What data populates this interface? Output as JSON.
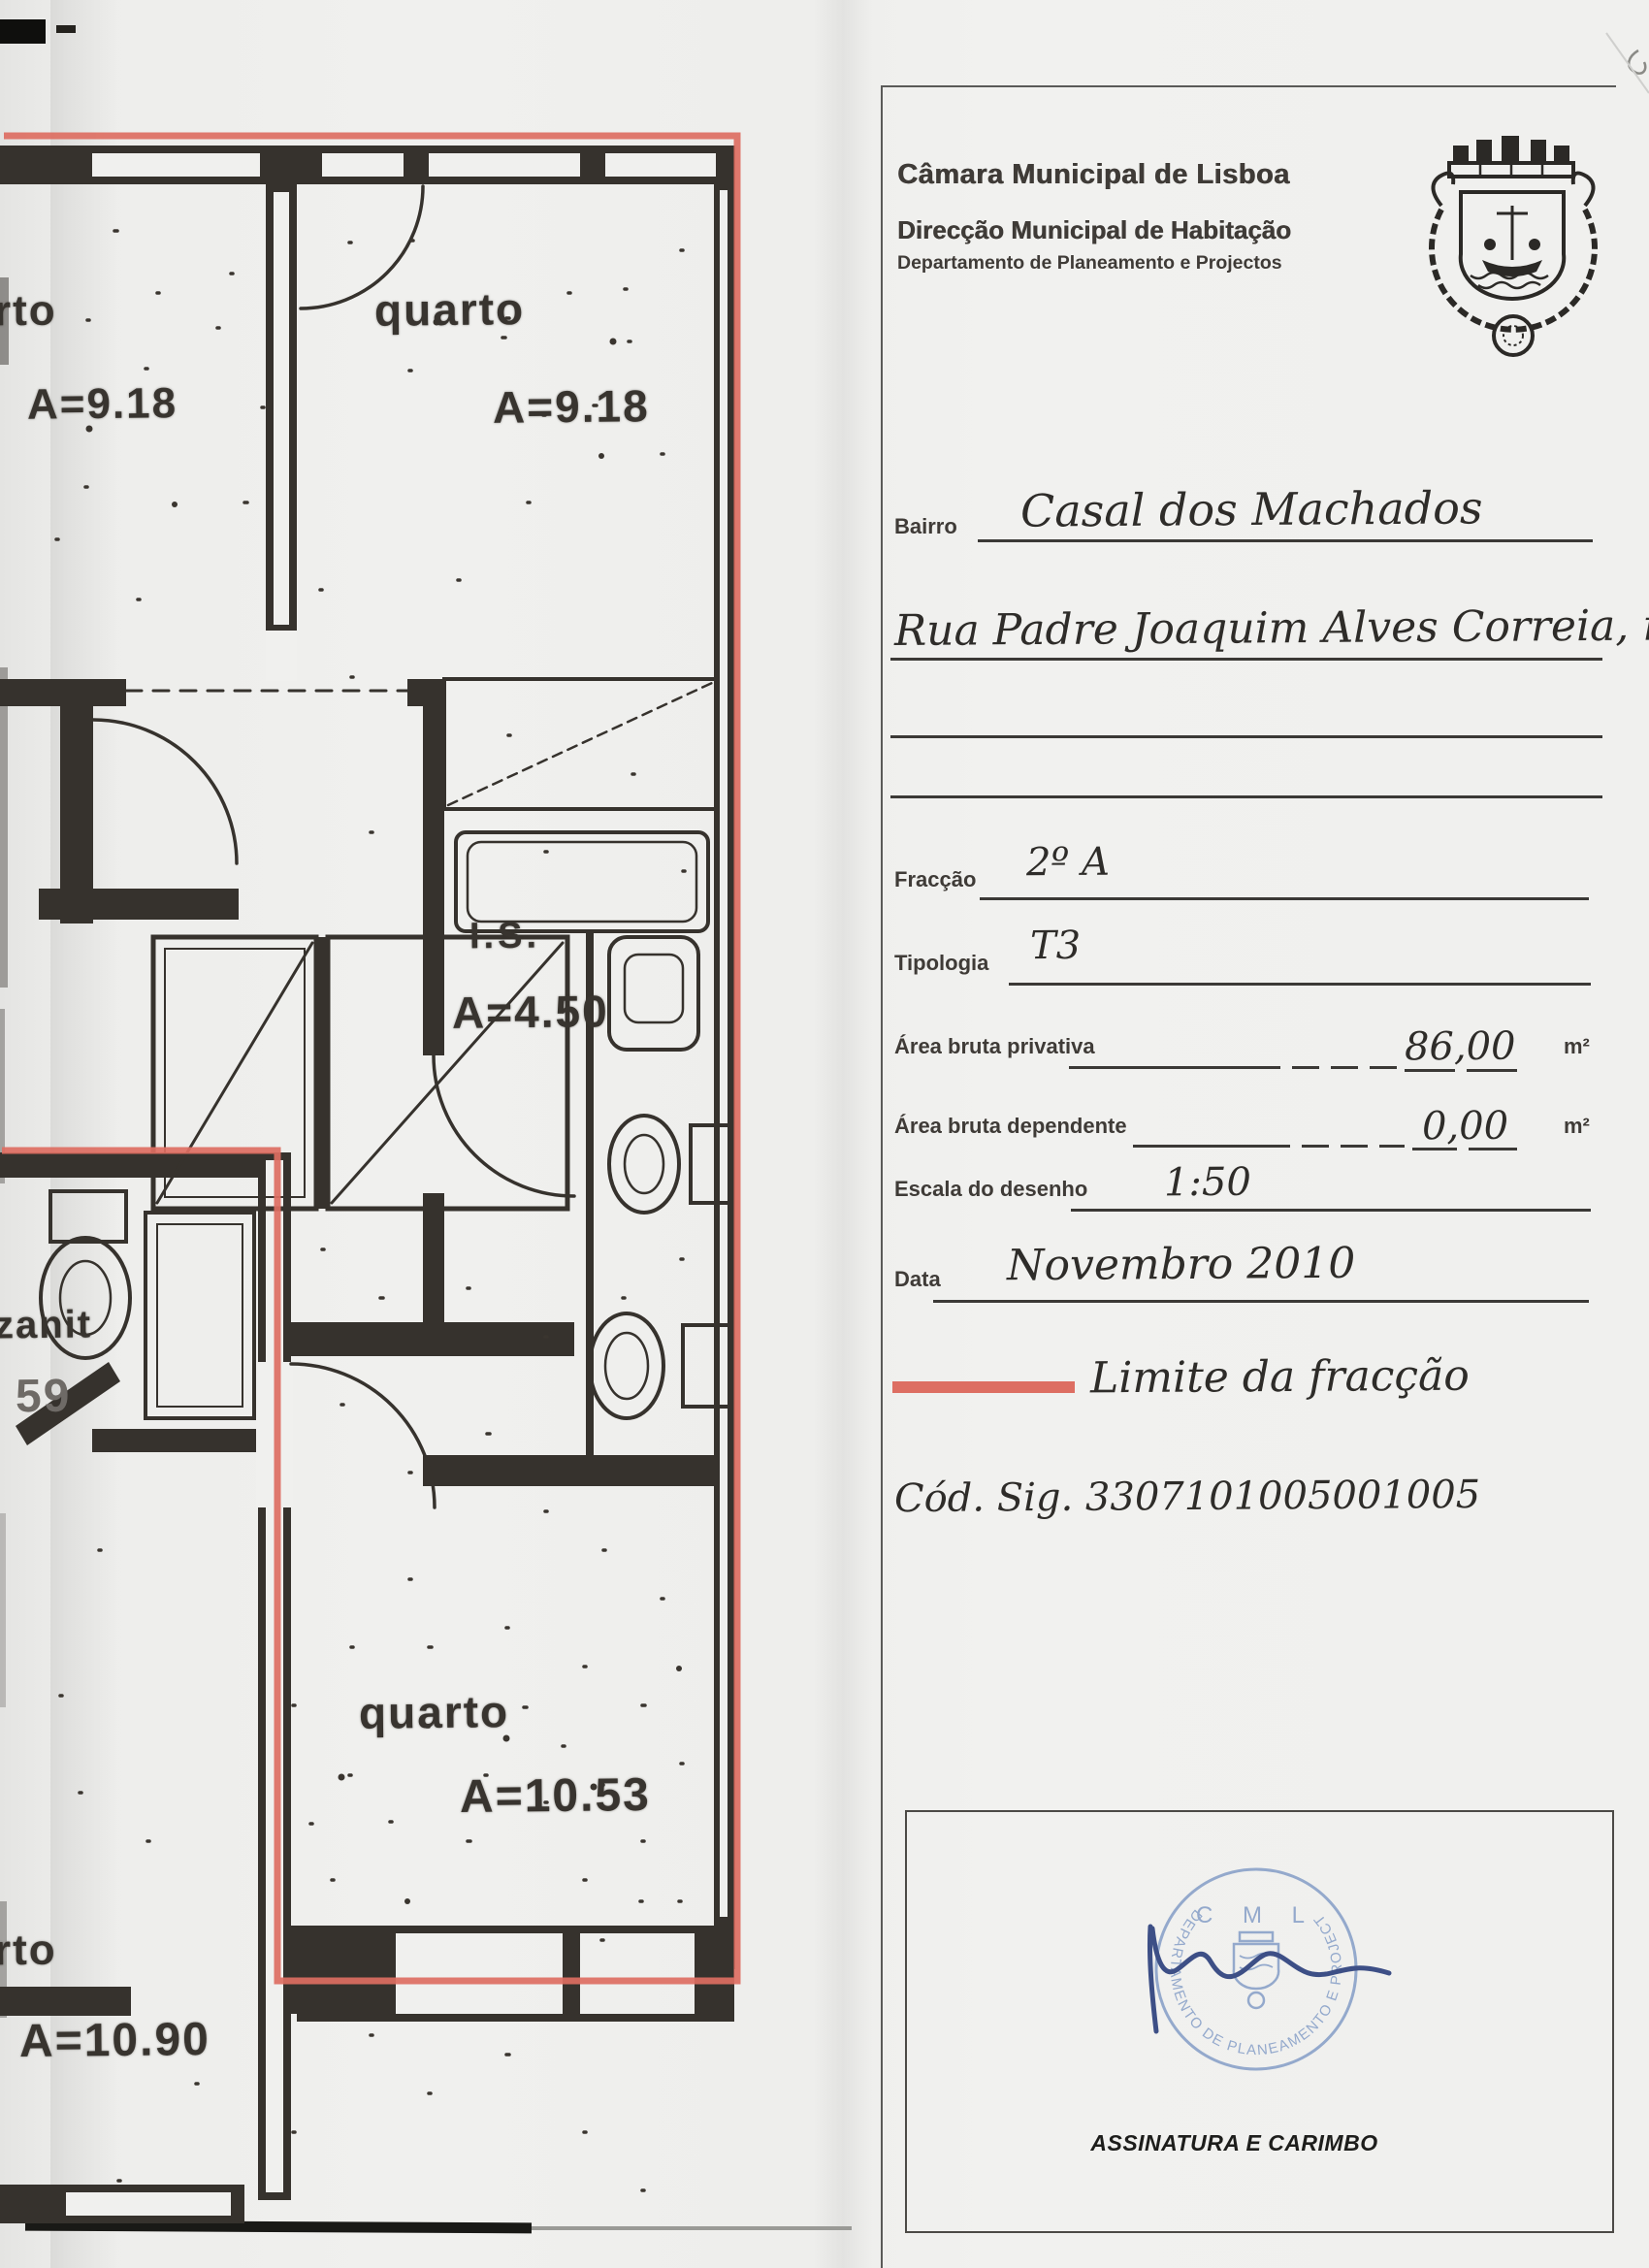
{
  "header": {
    "org": "Câmara Municipal de Lisboa",
    "dept": "Direcção Municipal de Habitação",
    "subdept": "Departamento de Planeamento e Projectos"
  },
  "form": {
    "bairro_label": "Bairro",
    "bairro_value": "Casal dos Machados",
    "address_value": "Rua Padre Joaquim Alves Correia, nº 6",
    "fraccao_label": "Fracção",
    "fraccao_value": "2º A",
    "tipologia_label": "Tipologia",
    "tipologia_value": "T3",
    "area_privativa_label": "Área bruta privativa",
    "area_privativa_value": "86,00",
    "area_privativa_unit": "m²",
    "area_dependente_label": "Área bruta dependente",
    "area_dependente_value": "0,00",
    "area_dependente_unit": "m²",
    "escala_label": "Escala do desenho",
    "escala_value": "1:50",
    "data_label": "Data",
    "data_value": "Novembro 2010",
    "legend_label": "Limite da fracção",
    "cod_sig": "Cód. Sig. 3307101005001005"
  },
  "signature_box": {
    "caption": "ASSINATURA E CARIMBO",
    "stamp_top": "C M L",
    "stamp_ring": "DEPARTAMENTO DE PLANEAMENTO E PROJECTOS"
  },
  "plan": {
    "room_top_left": {
      "name": "rto",
      "area": "A=9.18"
    },
    "room_top_right": {
      "name": "quarto",
      "area": "A=9.18"
    },
    "bathroom": {
      "name": "I.S.",
      "area": "A=4.50"
    },
    "room_left_partial": {
      "name": "zanit",
      "area": "59"
    },
    "room_bottom": {
      "name": "quarto",
      "area": "A=10.53"
    },
    "room_bottom_left": {
      "name": "rto",
      "area": "A=10.90"
    }
  },
  "colors": {
    "fraction_boundary": "#dd6e62",
    "stamp_blue": "#8aa2c9",
    "signature_ink": "#3d4f86",
    "wall_ink": "#36322d"
  }
}
